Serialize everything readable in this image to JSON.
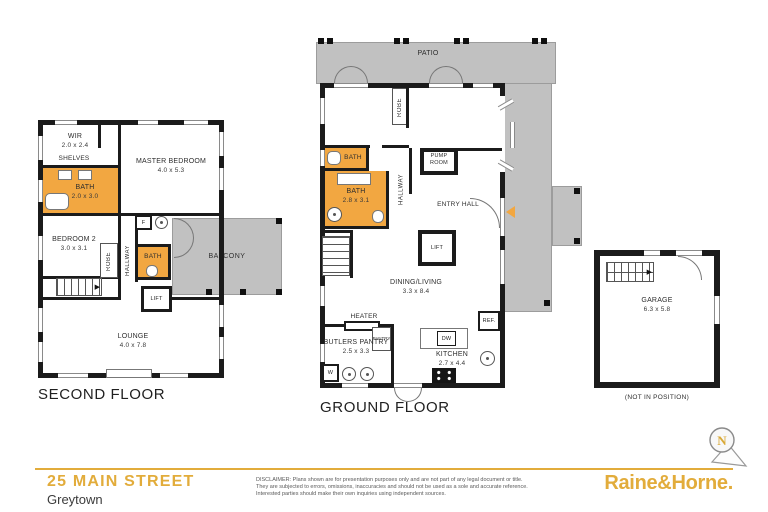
{
  "titles": {
    "second": "SECOND FLOOR",
    "ground": "GROUND FLOOR"
  },
  "second_floor": {
    "rooms": {
      "wir": {
        "name": "WIR",
        "dims": "2.0 x 2.4"
      },
      "shelves": {
        "name": "SHELVES"
      },
      "master": {
        "name": "MASTER BEDROOM",
        "dims": "4.0 x 5.3"
      },
      "bath": {
        "name": "BATH",
        "dims": "2.0 x 3.0"
      },
      "bedroom2": {
        "name": "BEDROOM 2",
        "dims": "3.0 x 3.1"
      },
      "robe": {
        "name": "ROBE"
      },
      "hallway": {
        "name": "HALLWAY"
      },
      "bath_small": {
        "name": "BATH"
      },
      "fireplace": {
        "name": "F"
      },
      "lift": {
        "name": "LIFT"
      },
      "balcony": {
        "name": "BALCONY"
      },
      "lounge": {
        "name": "LOUNGE",
        "dims": "4.0 x 7.8"
      }
    }
  },
  "ground_floor": {
    "rooms": {
      "patio": {
        "name": "PATIO"
      },
      "bedroom3": {
        "name": "BEDROOM 3",
        "dims": "3.2 x 3.2"
      },
      "robe": {
        "name": "ROBE"
      },
      "lounge": {
        "name": "LOUNGE",
        "dims": "4.8 x 5.3"
      },
      "bath_small": {
        "name": "BATH"
      },
      "bath": {
        "name": "BATH",
        "dims": "2.8 x 3.1"
      },
      "hallway": {
        "name": "HALLWAY"
      },
      "pump_room": {
        "name": "PUMP ROOM"
      },
      "entry_hall": {
        "name": "ENTRY HALL"
      },
      "lift": {
        "name": "LIFT"
      },
      "dining_living": {
        "name": "DINING/LIVING",
        "dims": "3.3 x 8.4"
      },
      "heater": {
        "name": "HEATER"
      },
      "pantry": {
        "name": "PANTRY"
      },
      "butlers_pantry": {
        "name": "BUTLERS PANTRY",
        "dims": "2.5 x 3.3"
      },
      "kitchen": {
        "name": "KITCHEN",
        "dims": "2.7 x 4.4"
      },
      "dw": {
        "name": "DW"
      },
      "ref": {
        "name": "REF."
      },
      "w": {
        "name": "W"
      }
    }
  },
  "garage": {
    "note": "(NOT IN POSITION)",
    "rooms": {
      "garage": {
        "name": "GARAGE",
        "dims": "6.3 x 5.8"
      }
    }
  },
  "compass": {
    "label": "N"
  },
  "icons": {
    "stairs_arrow": "▶"
  },
  "footer": {
    "address1": "25 MAIN STREET",
    "address2": "Greytown",
    "brand": "Raine&Horne.",
    "disclaimer1": "DISCLAIMER: Plans shown are for presentation purposes only and are not part of any legal document or title.",
    "disclaimer2": "They are subjected to errors, omissions, inaccuracies and should not be used as a sole and accurate reference.",
    "disclaimer3": "Interested parties should make their own inquiries using independent sources."
  },
  "colors": {
    "accent": "#E2AC3B",
    "highlight": "#F2A741",
    "outdoor": "#C1C1C1",
    "wall": "#1B1B1B"
  }
}
